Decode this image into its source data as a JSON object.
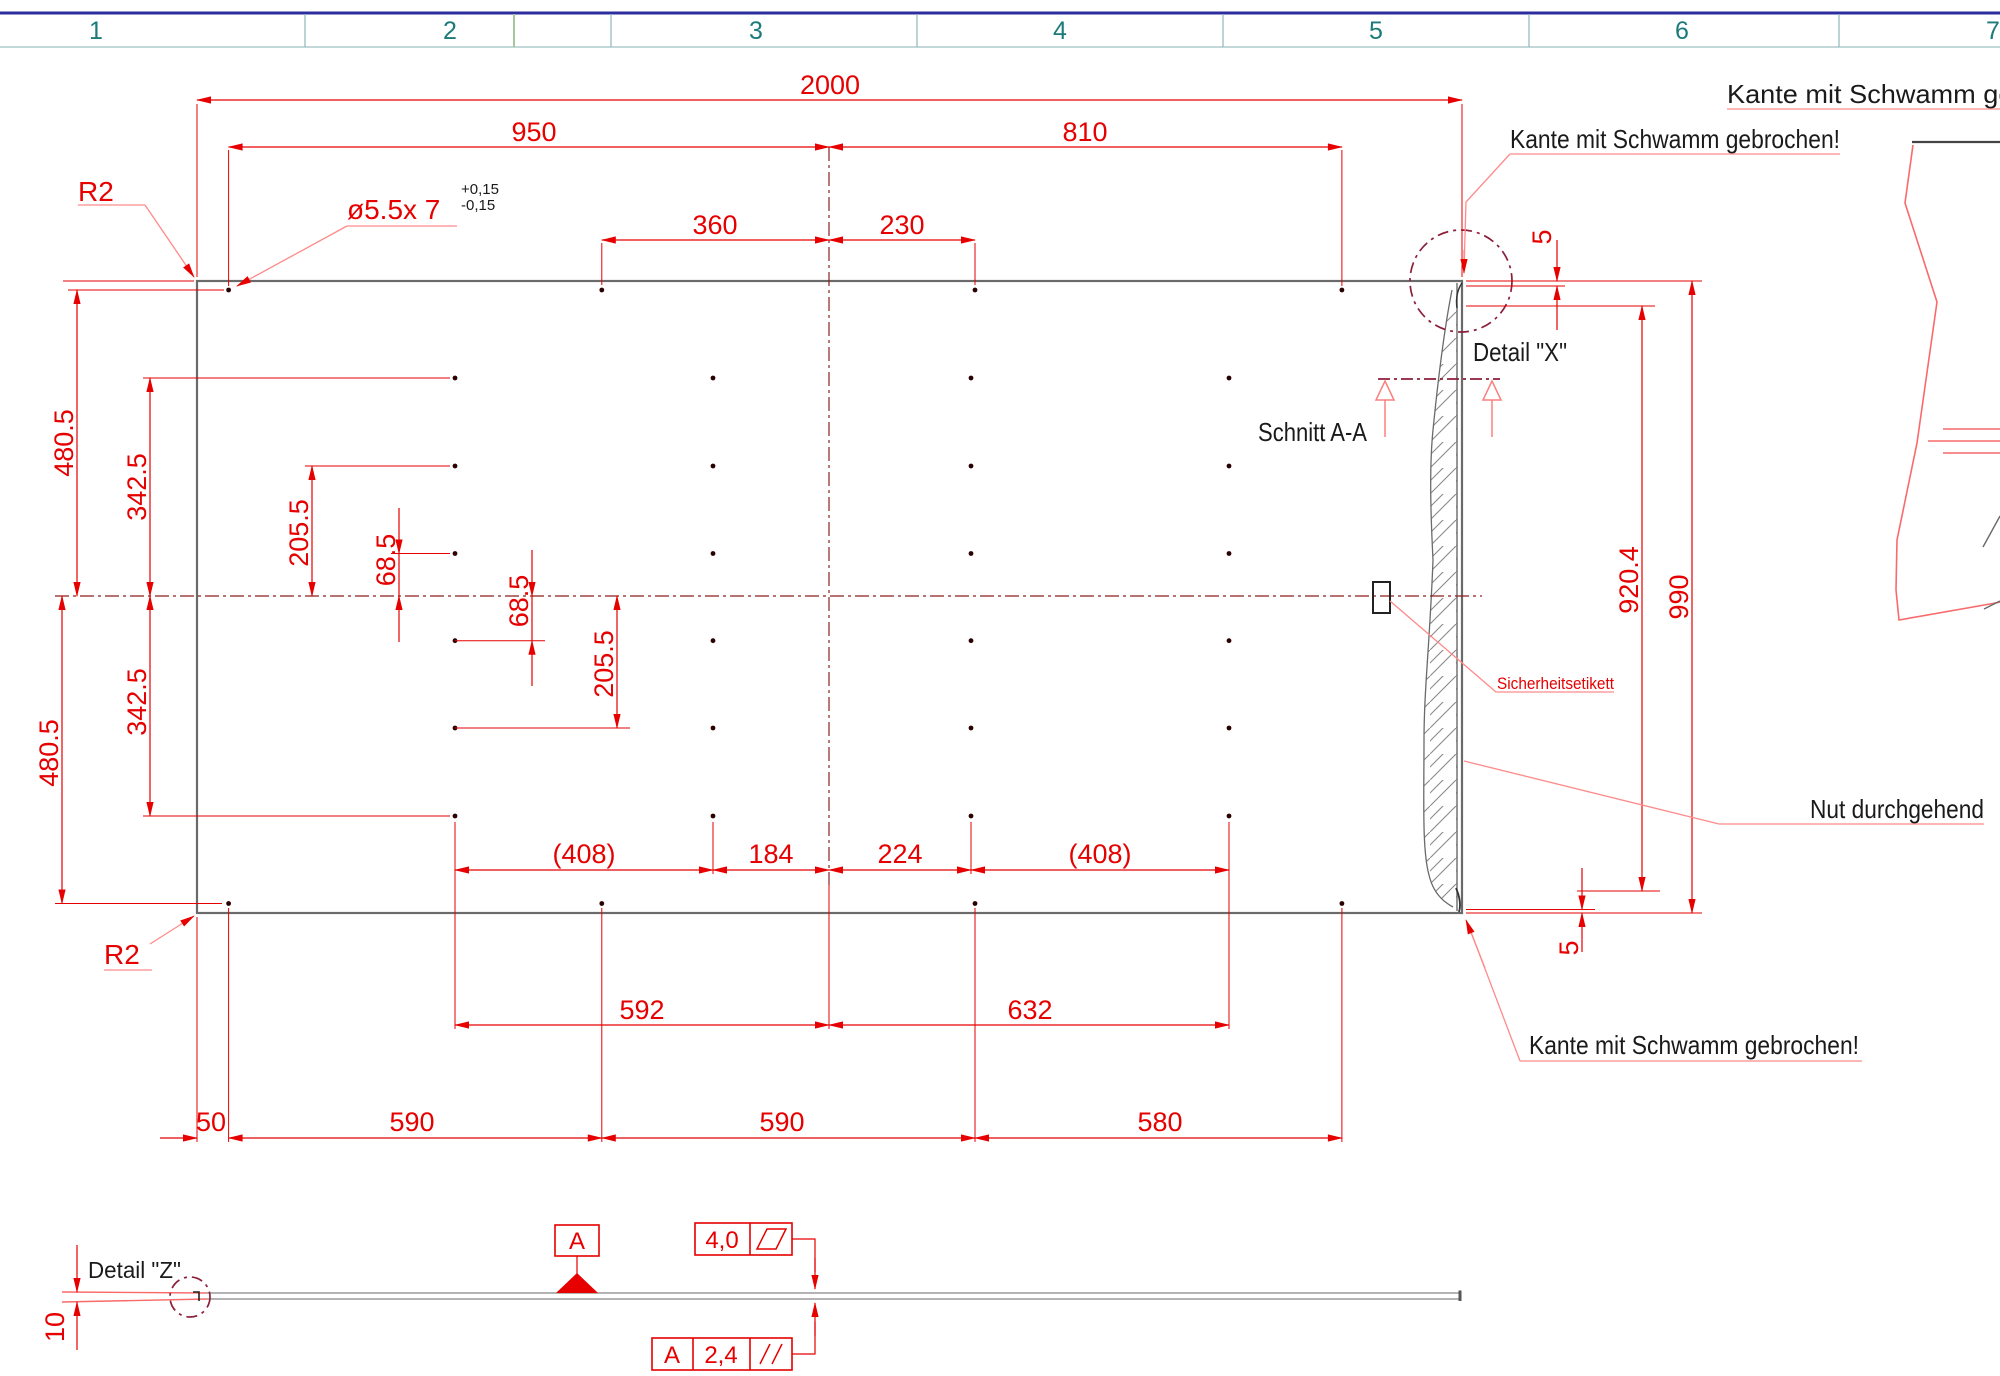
{
  "ruler": {
    "zones": [
      "1",
      "2",
      "3",
      "4",
      "5",
      "6",
      "7"
    ]
  },
  "dims": {
    "total_width": "2000",
    "w950": "950",
    "w810": "810",
    "w360": "360",
    "w230": "230",
    "h480_5": "480.5",
    "h342_5": "342.5",
    "h205_5": "205.5",
    "h68_5": "68.5",
    "b408a": "(408)",
    "b184": "184",
    "b224": "224",
    "b408b": "(408)",
    "b592": "592",
    "b632": "632",
    "b50": "50",
    "b590a": "590",
    "b590b": "590",
    "b580": "580",
    "r5top": "5",
    "r920": "920.4",
    "r990": "990",
    "r5bot": "5",
    "thickness10": "10",
    "r2top": "R2",
    "r2bot": "R2",
    "hole_callout": "ø5.5x 7",
    "tol_plus": "+0,15",
    "tol_minus": "-0,15"
  },
  "labels": {
    "kante_top_right": "Kante mit Schwamm gebrochen!",
    "kante_corner": "Kante mit Schwamm gebrochen!",
    "kante_bottom": "Kante mit Schwamm gebrochen!",
    "detail_x": "Detail \"X\"",
    "detail_z": "Detail \"Z\"",
    "schnitt": "Schnitt A-A",
    "sicherheitsetikett": "Sicherheitsetikett",
    "nut": "Nut durchgehend"
  },
  "flags": {
    "datum_letter": "A",
    "surface_top_value": "4,0",
    "surface_bottom_datum": "A",
    "surface_bottom_value": "2,4"
  },
  "colors": {
    "dim_red": "#e60000",
    "leader_red": "#ff8a8a",
    "centerline": "#8c1f1f",
    "detail_ring": "#8c1f3a",
    "outline_gray": "#6a6a6a",
    "hatch_gray": "#8a8a8a",
    "zone_teal": "#1b7a7a",
    "header_navy": "#2d2d9e",
    "band_border": "#8fb8b8",
    "green_tick": "#a6c79d",
    "text_black": "#1a1a1a"
  }
}
